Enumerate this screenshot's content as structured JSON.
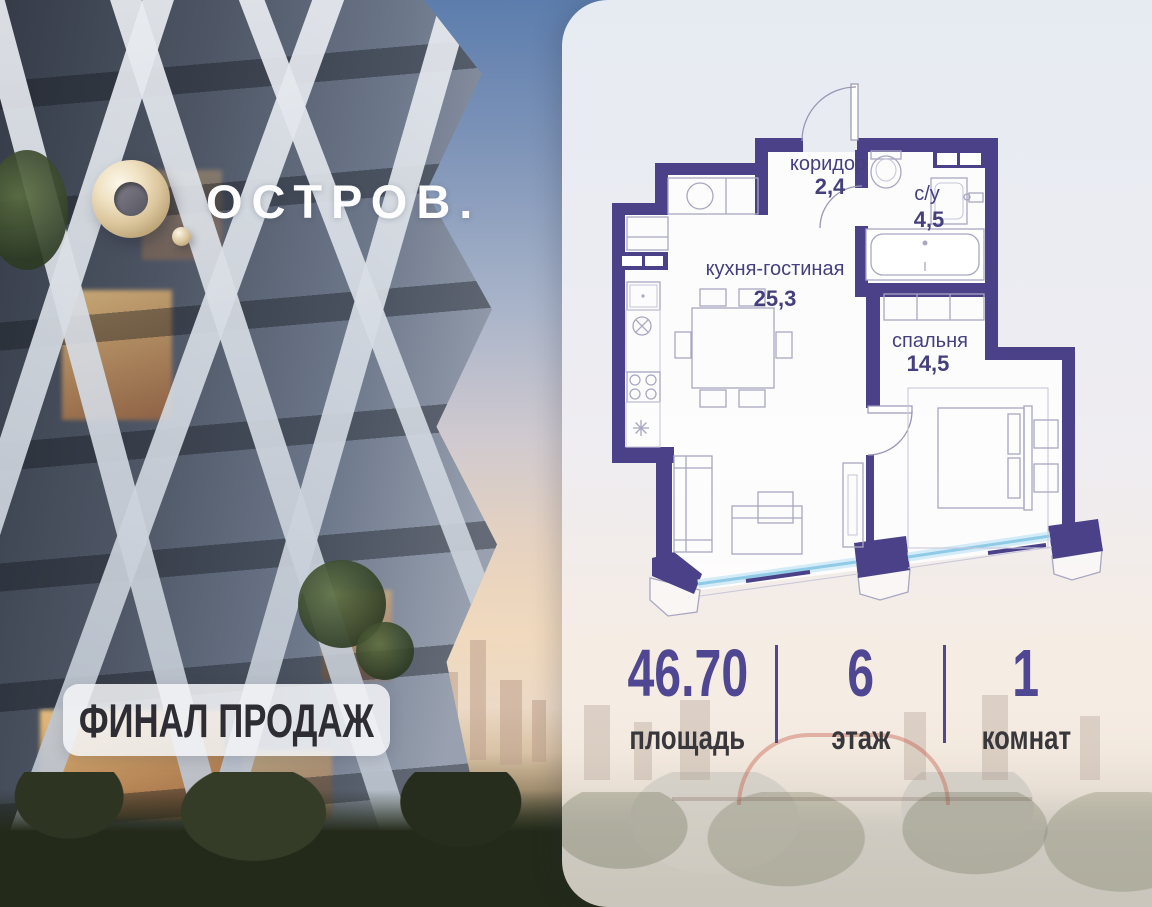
{
  "brand": {
    "logo_text": "ОСТРОВ."
  },
  "badge": {
    "label": "ФИНАЛ ПРОДАЖ"
  },
  "floorplan": {
    "rooms": [
      {
        "name": "коридор",
        "area": "2,4"
      },
      {
        "name": "с/у",
        "area": "4,5"
      },
      {
        "name": "кухня-гостиная",
        "area": "25,3"
      },
      {
        "name": "спальня",
        "area": "14,5"
      }
    ]
  },
  "stats": {
    "items": [
      {
        "value": "46.70",
        "label": "площадь"
      },
      {
        "value": "6",
        "label": "этаж"
      },
      {
        "value": "1",
        "label": "комнат"
      }
    ]
  },
  "colors": {
    "wall": "#4a4189",
    "accent": "#4f4792",
    "room_label": "#453f7d",
    "window_glass": "#8fcbe6",
    "logo_gold": "#d9c39a",
    "badge_text": "#2e2d33"
  }
}
